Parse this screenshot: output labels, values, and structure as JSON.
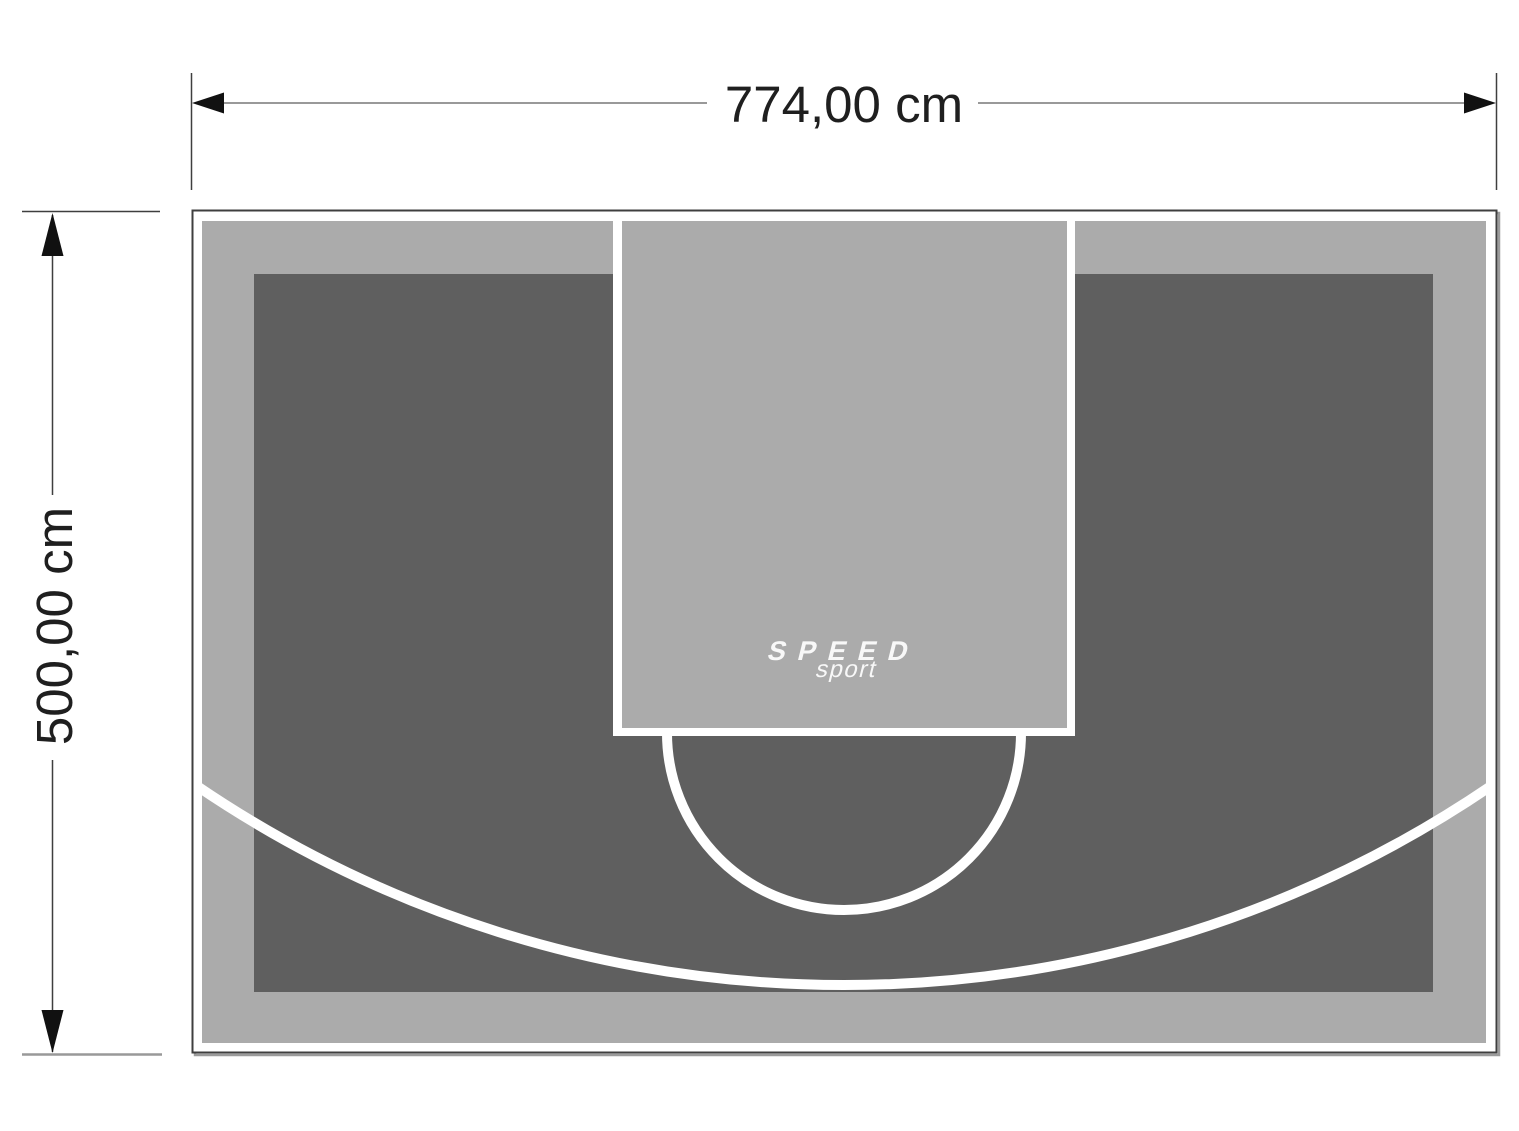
{
  "diagram": {
    "width_dimension": {
      "label": "774,00 cm"
    },
    "height_dimension": {
      "label": "500,00 cm"
    },
    "logo": {
      "line1": "SPEED",
      "line2": "sport"
    }
  },
  "colors": {
    "page_bg": "#ffffff",
    "court_border": "#3f3f3f",
    "border_shadow": "#9b9b9b",
    "perimeter_band": "#ababab",
    "inner_area": "#5f5f5f",
    "key_fill": "#ababab",
    "court_lines": "#ffffff",
    "dimension_line": "#999999",
    "dimension_text": "#1f1f1f",
    "arrowhead": "#111111",
    "logo_text": "#f8f8f8"
  }
}
